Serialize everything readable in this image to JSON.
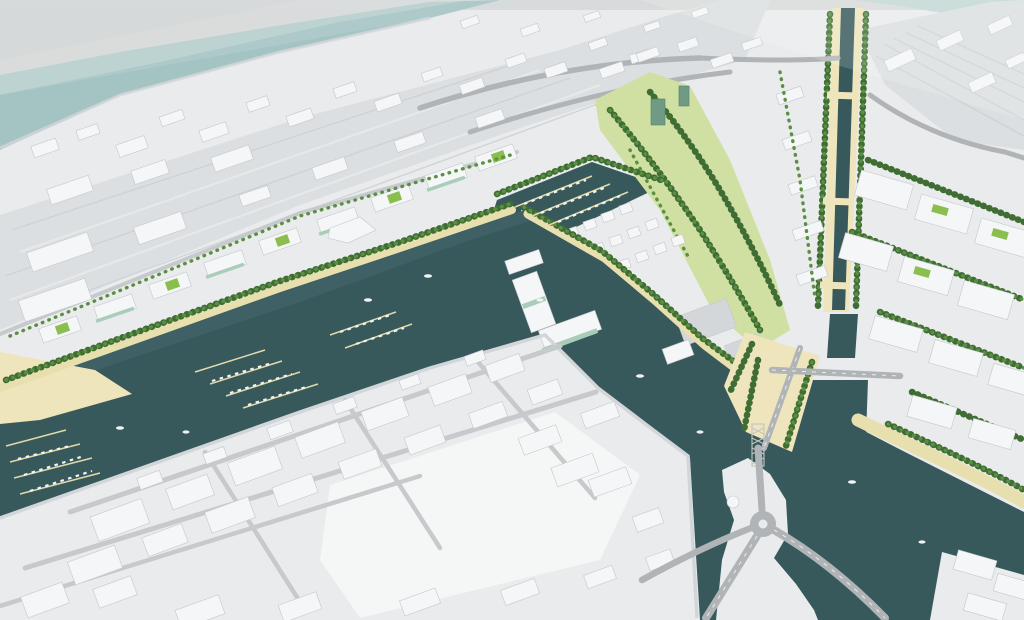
{
  "scene": {
    "type": "aerial-3d-masterplan-render",
    "description": "Bird's-eye architectural rendering of a waterfront urban masterplan: white massing models of the existing city surround a new canal district with tree-lined quays, marinas, green-roofed buildings, a harbour channel, a lift bridge and a roundabout.",
    "regions": [
      "sky-haze",
      "open-sea",
      "existing-city-north",
      "rail-corridor",
      "beach",
      "waterfront-residential-strip",
      "harbour-basin",
      "marina-docks",
      "central-development",
      "inner-marina",
      "linear-canal",
      "canal-bridges",
      "eastern-perimeter-blocks",
      "rail-yard-east",
      "southern-old-town",
      "wide-channel",
      "bridge-esplanade",
      "lift-bridge-pylon",
      "roundabout",
      "causeway-road",
      "corner-piers"
    ]
  },
  "palette": {
    "sky": "#d6d9d9",
    "sea": "#a4c3c3",
    "sea_light": "#c2d8d6",
    "land": "#e9ebec",
    "land_bright": "#f5f6f6",
    "corridor": "#dcdfe1",
    "water": "#38595c",
    "water_light": "#46696d",
    "sand": "#e8dfae",
    "sand_light": "#eee5bc",
    "tree_dark": "#3f6d33",
    "tree_mid": "#5c8f43",
    "lawn_light": "#cfe0a2",
    "roof_green": "#8abf4f",
    "glass_green": "#a8cdb8",
    "glass_dark": "#6f9b84",
    "bldg_white": "#f5f6f7",
    "bldg_shade": "#c4c8cd",
    "bldg_gray": "#d4d7d9",
    "road": "#c6cacd",
    "asphalt": "#b0b4b7",
    "dock": "#e2d9ab",
    "boat_white": "#f2f4f4",
    "truss": "#c2c6c2"
  }
}
